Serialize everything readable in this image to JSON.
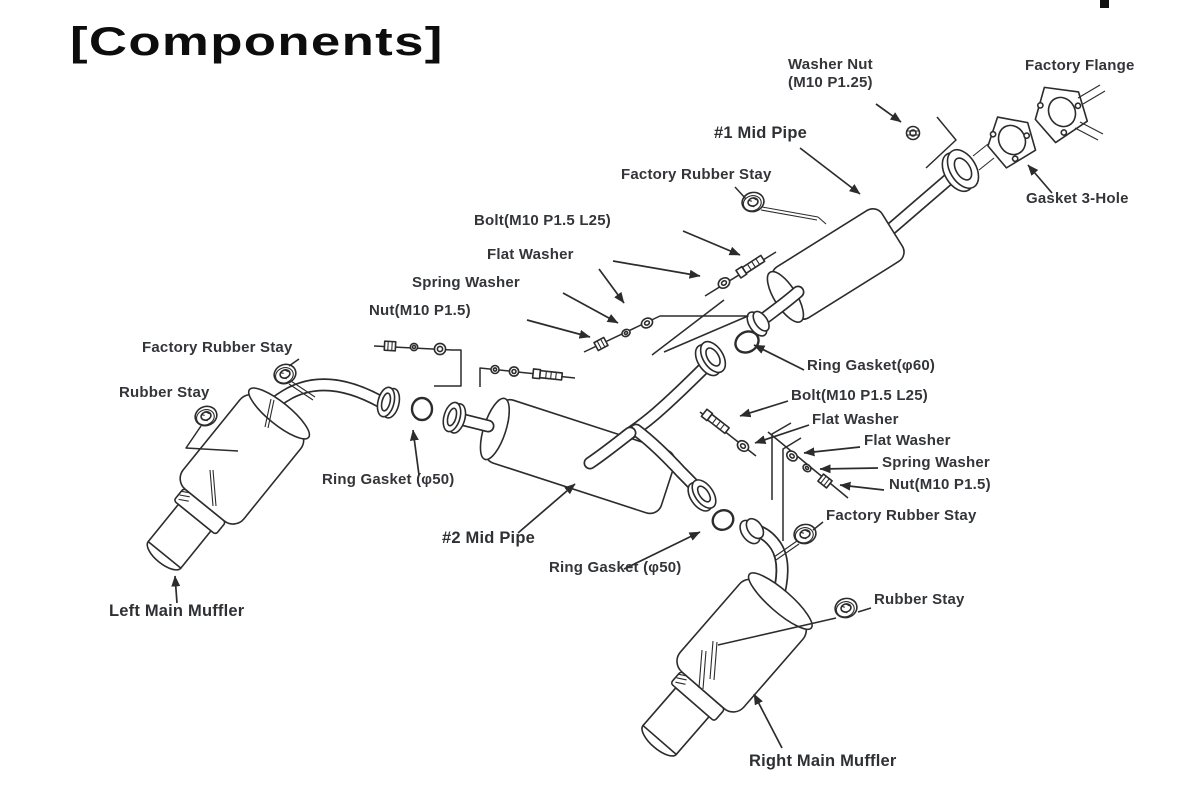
{
  "page": {
    "title": "[Components]"
  },
  "diagram": {
    "description_labels": {
      "washer_nut_1": "Washer Nut",
      "washer_nut_2": "(M10 P1.25)",
      "factory_flange": "Factory Flange",
      "mid_pipe_1": "#1 Mid Pipe",
      "factory_rubber_stay_top": "Factory Rubber Stay",
      "gasket_3_hole": "Gasket 3-Hole",
      "bolt_left": "Bolt(M10 P1.5 L25)",
      "flat_washer_left": "Flat Washer",
      "spring_washer_left": "Spring Washer",
      "nut_left": "Nut(M10 P1.5)",
      "factory_rubber_stay_left": "Factory Rubber Stay",
      "rubber_stay_left": "Rubber Stay",
      "ring_gasket_60": "Ring Gasket(φ60)",
      "bolt_right": "Bolt(M10 P1.5 L25)",
      "flat_washer_right_1": "Flat Washer",
      "flat_washer_right_2": "Flat Washer",
      "spring_washer_right": "Spring Washer",
      "nut_right": "Nut(M10 P1.5)",
      "factory_rubber_stay_right": "Factory Rubber Stay",
      "ring_gasket_50_left": "Ring Gasket (φ50)",
      "mid_pipe_2": "#2 Mid Pipe",
      "ring_gasket_50_right": "Ring Gasket (φ50)",
      "rubber_stay_right": "Rubber Stay",
      "left_main_muffler": "Left Main Muffler",
      "right_main_muffler": "Right Main Muffler"
    }
  }
}
